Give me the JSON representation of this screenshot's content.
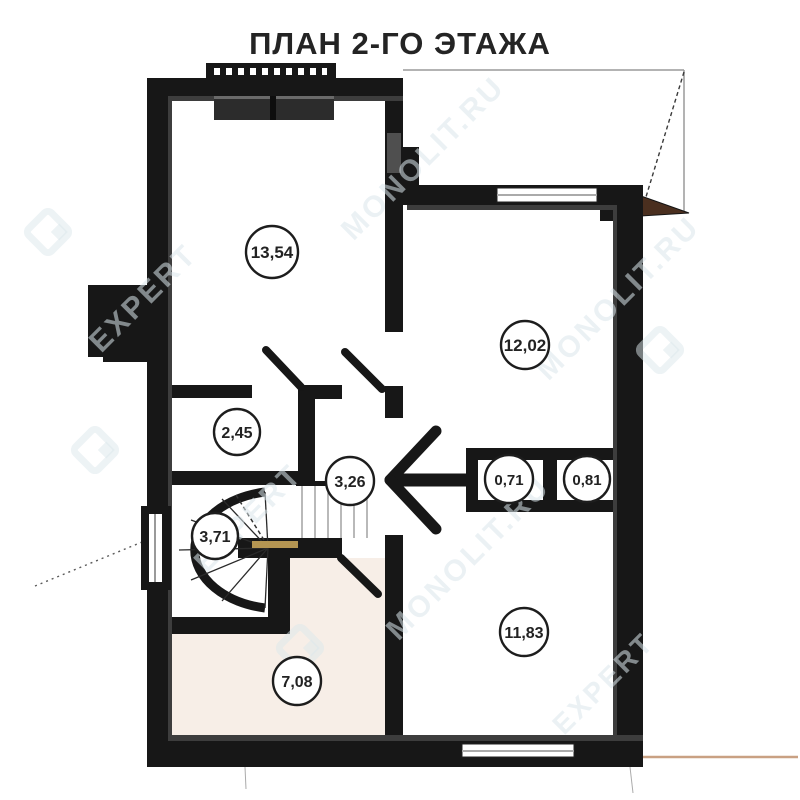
{
  "title": "ПЛАН 2-ГО ЭТАЖА",
  "rooms": [
    {
      "name": "living-room",
      "area": "13,54"
    },
    {
      "name": "bedroom",
      "area": "12,02"
    },
    {
      "name": "wardrobe",
      "area": "2,45"
    },
    {
      "name": "hall",
      "area": "3,26"
    },
    {
      "name": "closet-left",
      "area": "0,71"
    },
    {
      "name": "closet-right",
      "area": "0,81"
    },
    {
      "name": "stairwell",
      "area": "3,71"
    },
    {
      "name": "room-bottom-right",
      "area": "11,83"
    },
    {
      "name": "room-bottom-left",
      "area": "7,08"
    }
  ],
  "watermark": {
    "brand_top": "EXPERT",
    "brand_bottom": "MONOLIT.RU",
    "full": "EXPERT MONOLIT.RU"
  },
  "colors": {
    "wall": "#171717",
    "floor_accent_pink": "#f7eee7",
    "watermark": "#dbe7ec",
    "roof_wood": "#4a2f1f",
    "eave_line": "#c9a183",
    "stair_tread_accent": "#b49552",
    "title_text": "#242424"
  }
}
